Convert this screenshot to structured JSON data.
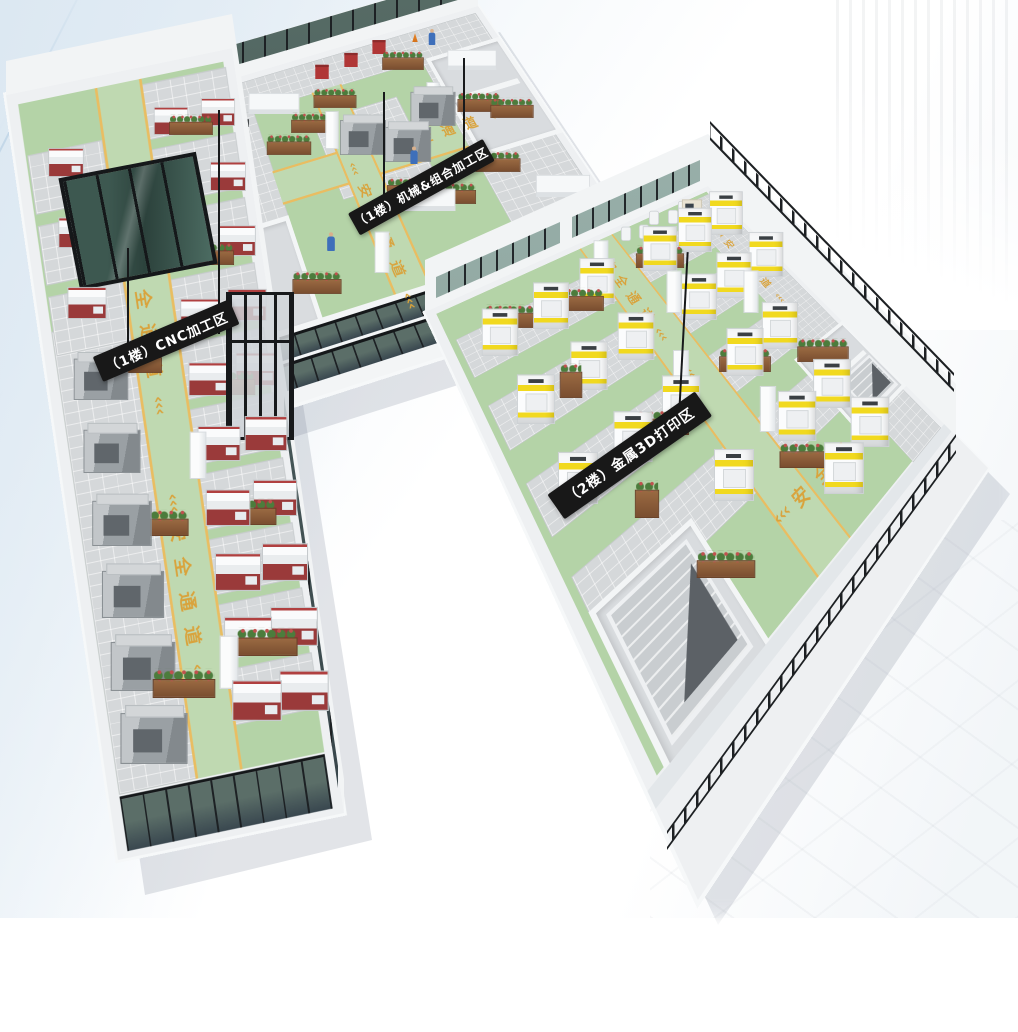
{
  "scene": {
    "description": "3D isometric smart-factory overview with three production zones",
    "banners": [
      {
        "id": "cnc",
        "label": "（1楼）CNC加工区"
      },
      {
        "id": "machining",
        "label": "（1楼）机械&组合加工区"
      },
      {
        "id": "printing",
        "label": "（2楼）金属3D打印区"
      }
    ],
    "floor_text": {
      "label": "安全通道",
      "chars": [
        "安",
        "全",
        "通",
        "道"
      ],
      "chevron": "‹‹‹"
    },
    "colors": {
      "floor_green": "#b4d3a7",
      "lane_green": "#bfd9b1",
      "lane_yellow": "#e9bd62",
      "floor_text_yellow": "#d9a33c",
      "machine_yellow": "#f1d91f",
      "machine_red": "#9a3a3a",
      "banner_bg": "#181818",
      "banner_text": "#ffffff",
      "wall_white": "#f2f4f5",
      "frame_black": "#1d2023",
      "plant_green": "#4c7c3c",
      "flower_red": "#c0504e"
    }
  }
}
